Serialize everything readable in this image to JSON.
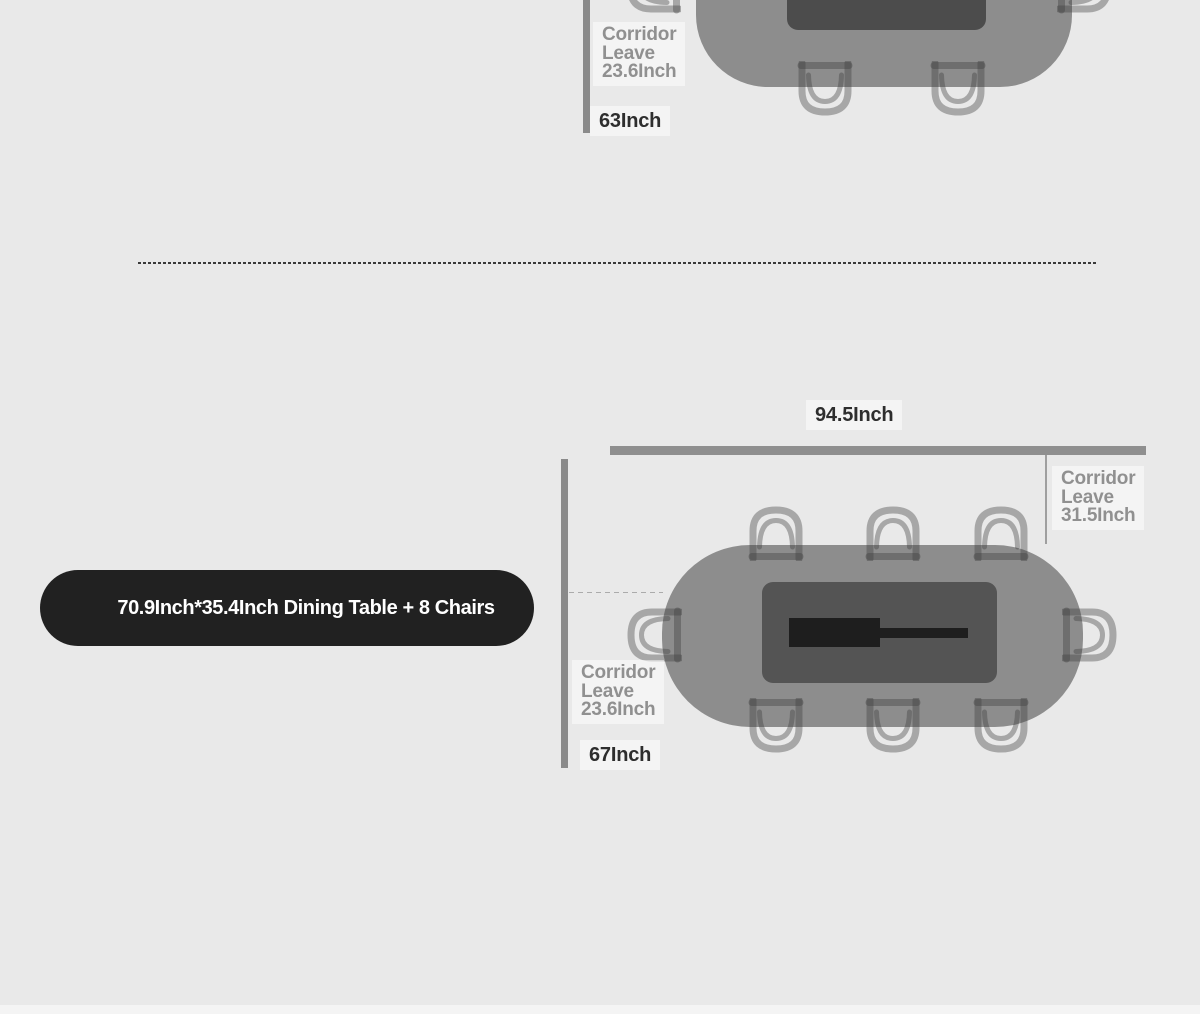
{
  "colors": {
    "page_bg": "#e9e9e9",
    "footer_strip": "#f4f4f4",
    "table_fill": "#8d8d8d",
    "table_top_panel_a": "#4c4c4c",
    "table_top_panel_b": "#545454",
    "slide_handle": "#1e1e1e",
    "chair_stroke": "rgba(60,60,60,0.38)",
    "wall_bar": "#8a8a8a",
    "dim_line": "#9f9f9f",
    "divider": "#3a3a3a",
    "label_gray": "#909090",
    "label_dark": "#2e2e2e",
    "plate_bg": "rgba(255,255,255,0.5)",
    "pill_bg": "#212121",
    "pill_text": "#ffffff"
  },
  "top_diagram": {
    "corridor_label": {
      "lines": [
        "Corridor",
        "Leave",
        "23.6Inch"
      ]
    },
    "length_label": "63Inch"
  },
  "bottom_diagram": {
    "width_label": "94.5Inch",
    "corridor_right_label": {
      "lines": [
        "Corridor",
        "Leave",
        "31.5Inch"
      ]
    },
    "corridor_left_label": {
      "lines": [
        "Corridor",
        "Leave",
        "23.6Inch"
      ]
    },
    "length_label": "67Inch",
    "product_label": "70.9Inch*35.4Inch Dining Table + 8 Chairs"
  }
}
